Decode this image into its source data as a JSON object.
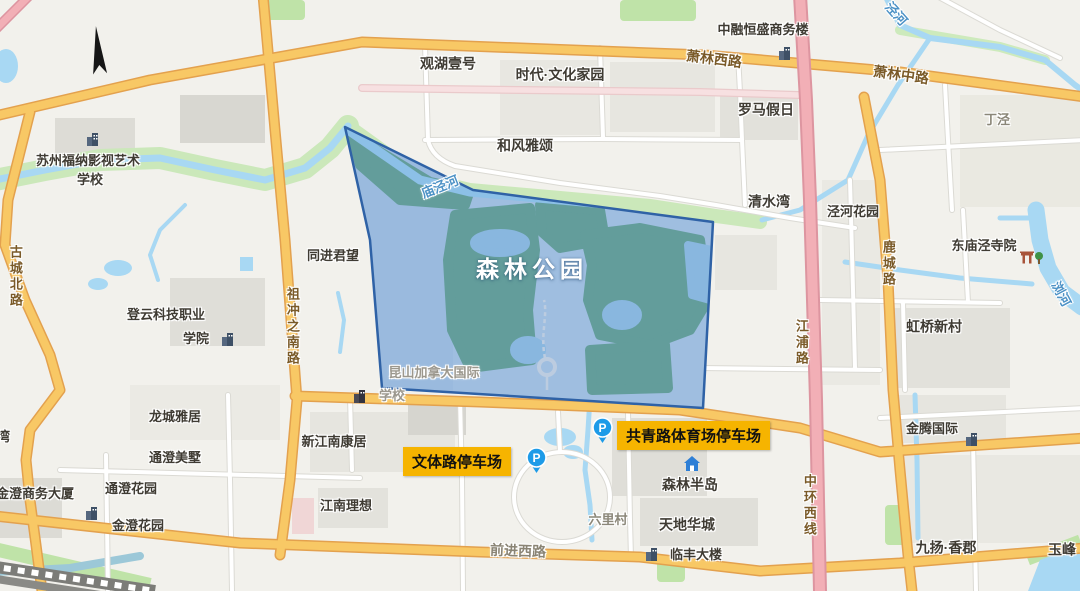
{
  "park": {
    "name": "森林公园"
  },
  "parking": {
    "wenti": "文体路停车场",
    "gongqing": "共青路体育场停车场",
    "symbol": "P"
  },
  "places": {
    "suzhou_funa_1": "苏州福纳影视艺术",
    "suzhou_funa_2": "学校",
    "guanhu": "观湖壹号",
    "shidai": "时代·文化家园",
    "hefeng": "和风雅颂",
    "zhongrong": "中融恒盛商务楼",
    "luoma": "罗马假日",
    "dingjing": "丁泾",
    "qingshui": "清水湾",
    "jinghe_garden": "泾河花园",
    "dongmiao": "东庙泾寺院",
    "hongqiao": "虹桥新村",
    "tongjin": "同进君望",
    "dengyun_1": "登云科技职业",
    "dengyun_2": "学院",
    "longcheng": "龙城雅居",
    "tongcheng_mei": "通澄美墅",
    "tongcheng_hua": "通澄花园",
    "jincheng_sw": "金澄商务大厦",
    "jincheng_hy": "金澄花园",
    "xinjiangnan": "新江南康居",
    "jiangnan_lx": "江南理想",
    "kunshan_1": "昆山加拿大国际",
    "kunshan_2": "学校",
    "senlin_bd": "森林半岛",
    "tiandi": "天地华城",
    "liulicun": "六里村",
    "linfeng": "临丰大楼",
    "jinteng": "金腾国际",
    "jiuyang": "九扬·香郡",
    "yufeng": "玉峰",
    "wan": "湾"
  },
  "roads": {
    "xiaolin_west": "萧林西路",
    "xiaolin_mid": "萧林中路",
    "gucheng_north": "古城北路",
    "zuchongzhi_south": "祖冲之南路",
    "lucheng": "鹿城路",
    "jiangpu": "江浦路",
    "zhonghuan_west": "中环西线",
    "qianjin_west": "前进西路"
  },
  "rivers": {
    "miaojing": "庙泾河",
    "jing": "泾河",
    "liu": "浏河"
  },
  "colors": {
    "highlight_fill": "#7D9ED4",
    "highlight_border": "#2F62A6",
    "parking_label_bg": "#F6B400",
    "parking_pin": "#1D9BE8",
    "major_road": "#F8C865",
    "expressway": "#F2AFB6",
    "water": "#A8D8F3",
    "park_green": "#5F9C90"
  }
}
